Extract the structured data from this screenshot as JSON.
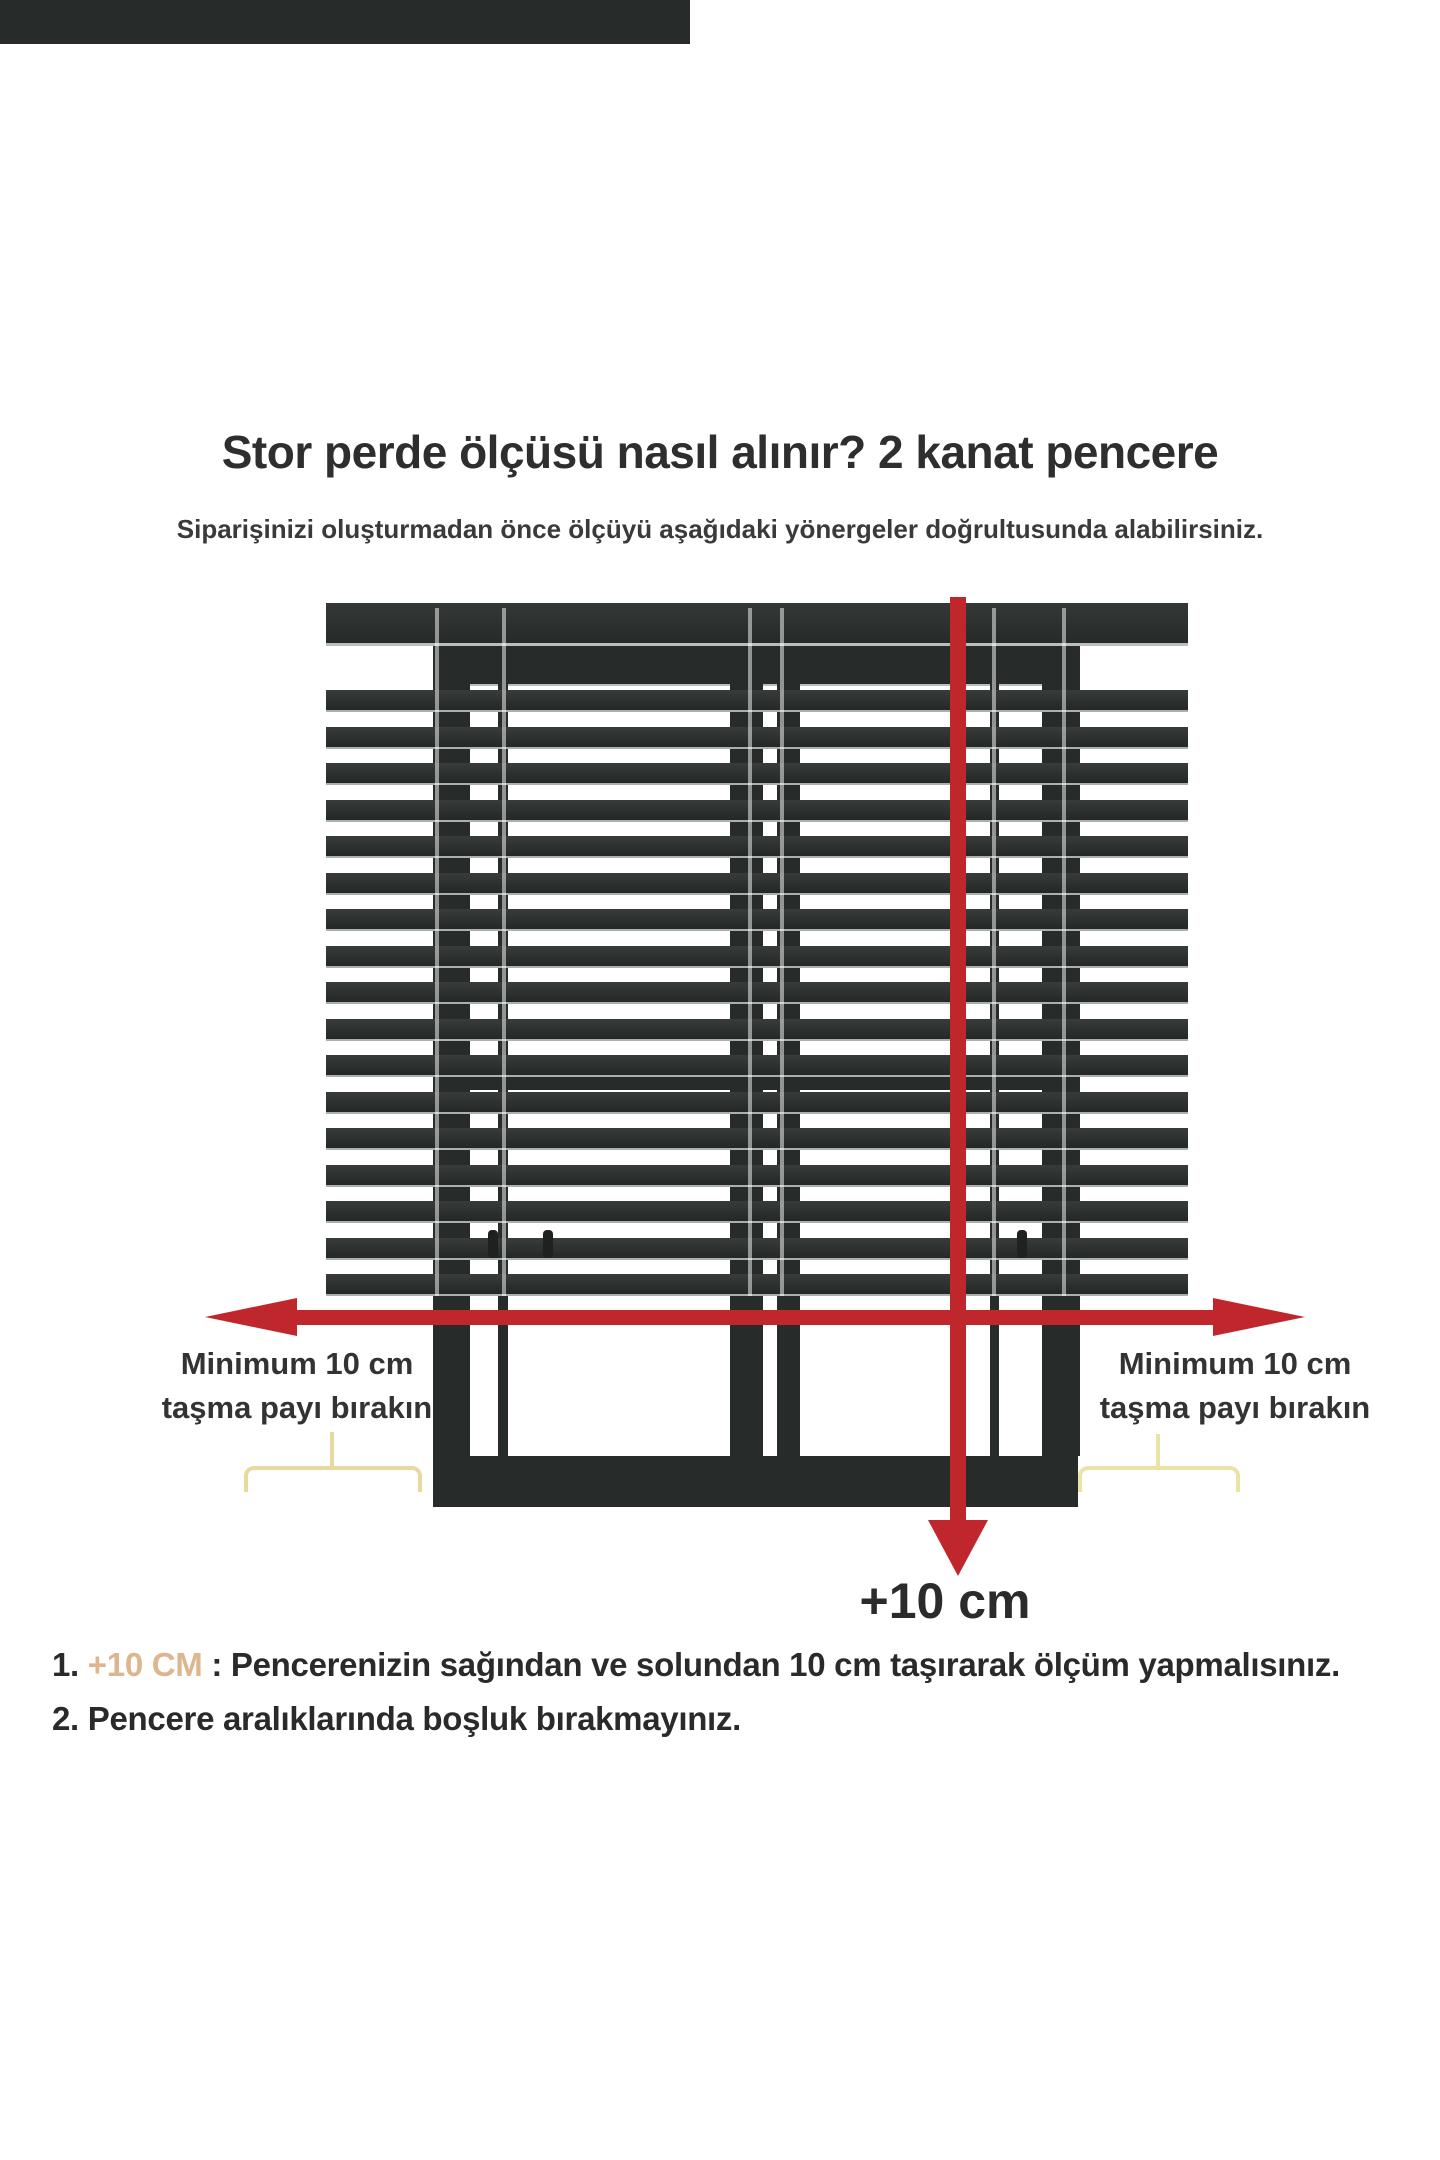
{
  "title": "Stor perde ölçüsü nasıl alınır? 2 kanat pencere",
  "subtitle": "Siparişinizi oluşturmadan önce ölçüyü aşağıdaki yönergeler doğrultusunda alabilirsiniz.",
  "labels": {
    "left_min_line1": "Minimum 10 cm",
    "left_min_line2": "taşma payı bırakın",
    "right_min_line1": "Minimum 10 cm",
    "right_min_line2": "taşma payı bırakın",
    "plus10_arrow_label": "+10 cm"
  },
  "notes": [
    {
      "num": "1.",
      "highlight": "+10 CM",
      "text": " : Pencerenizin sağından ve solundan 10 cm taşırarak ölçüm yapmalısınız."
    },
    {
      "num": "2.",
      "highlight": "",
      "text": " Pencere aralıklarında boşluk bırakmayınız."
    }
  ],
  "colors": {
    "arrow_red": "#c0272d",
    "blind_dark": "#2c302f",
    "frame_dark": "#272b2a",
    "brace_cream": "#e8d99e",
    "highlight_tan": "#dcb68e",
    "text_dark": "#333333"
  },
  "diagram": {
    "slat_count": 17,
    "type": "venetian-blind-over-2-wing-window"
  }
}
